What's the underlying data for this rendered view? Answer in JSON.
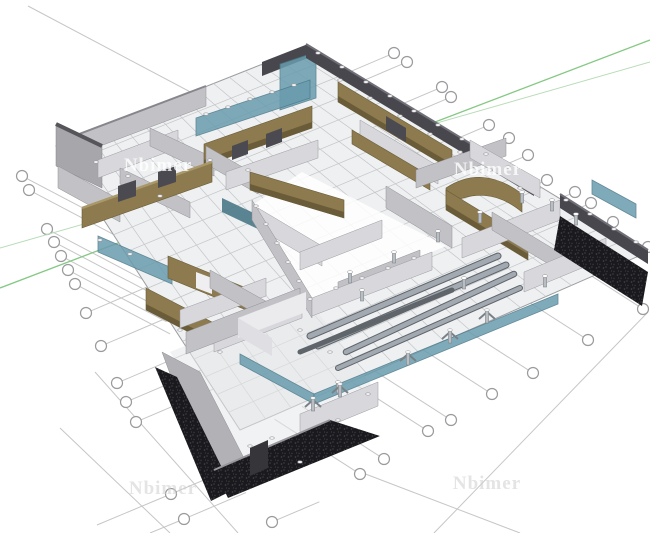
{
  "meta": {
    "description": "3D architectural BIM floor model viewed in SketchUp-style perspective viewport with structural grid axis bubbles",
    "canvas": {
      "width": 650,
      "height": 533
    }
  },
  "watermarks": [
    {
      "text": "Nbimer",
      "x": 158,
      "y": 166,
      "style": "light"
    },
    {
      "text": "Nbimer",
      "x": 488,
      "y": 170,
      "style": "light"
    },
    {
      "text": "Nbimer",
      "x": 163,
      "y": 489,
      "style": "gray"
    },
    {
      "text": "Nbimer",
      "x": 487,
      "y": 484,
      "style": "gray"
    }
  ],
  "colors": {
    "bg": "#ffffff",
    "floor": "#eef0f1",
    "tile": "#c3c5c8",
    "slabEdge": "#9b9da0",
    "wallL": "#d8d8dc",
    "wallM": "#c2c2c6",
    "wallD": "#a6a6ab",
    "wallTop": "#86868c",
    "parapet": "#47474d",
    "parapetTop": "#6f6f78",
    "wood": "#8d7a4e",
    "woodDark": "#6a5c38",
    "woodTop": "#a9986a",
    "glass": "#699cae",
    "glassDark": "#4a7888",
    "speckle": "#1a1a1e",
    "beam": "#a2a9b0",
    "beamDark": "#5f656b",
    "gridline": "#c6c6c8",
    "bubbleStroke": "#9a9a9e",
    "axisGreen": "#84c884",
    "axisGreenFaint": "#b8dcb8"
  },
  "axis_lines": [
    {
      "x1": 0,
      "y1": 288,
      "x2": 650,
      "y2": 40,
      "color": "#84c884",
      "w": 1.3
    },
    {
      "x1": 0,
      "y1": 248,
      "x2": 650,
      "y2": 62,
      "color": "#b8dcb8",
      "w": 1.0
    }
  ],
  "slab": {
    "corners": [
      [
        308,
        46
      ],
      [
        648,
        252
      ],
      [
        240,
        430
      ],
      [
        56,
        146
      ]
    ],
    "divisions": 16
  },
  "grid_bubbles": {
    "radius": 5.5,
    "groups": [
      {
        "name": "upper-left",
        "dir": [
          0.885,
          0.465
        ],
        "items": [
          [
            22,
            176,
            132
          ],
          [
            29,
            190,
            128
          ],
          [
            47,
            229,
            118
          ],
          [
            54,
            242,
            114
          ],
          [
            61,
            256,
            110
          ],
          [
            68,
            270,
            106
          ],
          [
            75,
            284,
            102
          ]
        ]
      },
      {
        "name": "lower-left",
        "dir": [
          0.92,
          -0.392
        ],
        "items": [
          [
            86,
            313,
            96
          ],
          [
            101,
            346,
            100
          ],
          [
            117,
            383,
            88
          ],
          [
            126,
            402,
            84
          ],
          [
            136,
            422,
            78
          ],
          [
            171,
            494,
            58
          ],
          [
            184,
            519,
            62
          ],
          [
            272,
            522,
            46
          ]
        ]
      },
      {
        "name": "upper-right",
        "dir": [
          -0.92,
          0.392
        ],
        "items": [
          [
            394,
            53,
            52
          ],
          [
            407,
            62,
            54
          ],
          [
            442,
            87,
            58
          ],
          [
            451,
            97,
            56
          ],
          [
            489,
            125,
            60
          ],
          [
            509,
            138,
            58
          ],
          [
            528,
            155,
            56
          ],
          [
            547,
            180,
            54
          ],
          [
            575,
            192,
            50
          ],
          [
            591,
            203,
            48
          ],
          [
            613,
            222,
            44
          ],
          [
            648,
            247,
            40
          ]
        ]
      },
      {
        "name": "lower-right",
        "dir": [
          -0.842,
          -0.54
        ],
        "items": [
          [
            360,
            474,
            96
          ],
          [
            384,
            459,
            92
          ],
          [
            428,
            431,
            84
          ],
          [
            451,
            420,
            88
          ],
          [
            492,
            394,
            92
          ],
          [
            533,
            373,
            96
          ],
          [
            588,
            340,
            100
          ],
          [
            643,
            309,
            104
          ]
        ]
      }
    ],
    "extra_lines": [
      [
        28,
        6,
        198,
        96
      ],
      [
        95,
        372,
        238,
        533
      ],
      [
        60,
        428,
        170,
        533
      ],
      [
        355,
        470,
        520,
        533
      ],
      [
        648,
        312,
        434,
        533
      ],
      [
        171,
        494,
        97,
        525
      ],
      [
        184,
        519,
        150,
        533
      ]
    ]
  },
  "columns": {
    "plain": [
      [
        350,
        272
      ],
      [
        394,
        252
      ],
      [
        438,
        231
      ],
      [
        480,
        212
      ],
      [
        522,
        192
      ],
      [
        362,
        290
      ],
      [
        338,
        382
      ],
      [
        464,
        278
      ],
      [
        545,
        276
      ],
      [
        552,
        200
      ],
      [
        576,
        214
      ]
    ],
    "y_braced": [
      [
        408,
        352
      ],
      [
        450,
        330
      ],
      [
        487,
        310
      ],
      [
        313,
        398
      ],
      [
        340,
        384
      ]
    ],
    "caps": [
      [
        318,
        53
      ],
      [
        342,
        67
      ],
      [
        366,
        82
      ],
      [
        390,
        96
      ],
      [
        414,
        111
      ],
      [
        438,
        125
      ],
      [
        462,
        139
      ],
      [
        486,
        154
      ],
      [
        508,
        167
      ],
      [
        566,
        200
      ],
      [
        590,
        214
      ],
      [
        614,
        229
      ],
      [
        636,
        242
      ],
      [
        206,
        114
      ],
      [
        228,
        107
      ],
      [
        250,
        99
      ],
      [
        272,
        92
      ],
      [
        294,
        85
      ],
      [
        256,
        206
      ],
      [
        266,
        224
      ],
      [
        277,
        243
      ],
      [
        288,
        262
      ],
      [
        299,
        281
      ],
      [
        310,
        299
      ],
      [
        336,
        288
      ],
      [
        362,
        278
      ],
      [
        388,
        268
      ],
      [
        414,
        258
      ],
      [
        96,
        162
      ],
      [
        128,
        176
      ],
      [
        160,
        196
      ],
      [
        210,
        160
      ],
      [
        248,
        170
      ],
      [
        340,
        80
      ],
      [
        370,
        98
      ],
      [
        400,
        116
      ],
      [
        430,
        134
      ],
      [
        460,
        152
      ],
      [
        490,
        170
      ],
      [
        520,
        188
      ],
      [
        100,
        240
      ],
      [
        130,
        254
      ],
      [
        250,
        446
      ],
      [
        272,
        438
      ],
      [
        300,
        462
      ],
      [
        338,
        420
      ],
      [
        368,
        394
      ],
      [
        180,
        330
      ],
      [
        220,
        352
      ],
      [
        300,
        330
      ],
      [
        330,
        352
      ]
    ]
  },
  "beams": [
    {
      "x1": 310,
      "y1": 336,
      "x2": 498,
      "y2": 256,
      "w": 5
    },
    {
      "x1": 318,
      "y1": 346,
      "x2": 506,
      "y2": 265,
      "w": 5
    },
    {
      "x1": 346,
      "y1": 352,
      "x2": 514,
      "y2": 274,
      "w": 4.5
    },
    {
      "x1": 300,
      "y1": 352,
      "x2": 452,
      "y2": 290,
      "w": 3,
      "dark": true
    },
    {
      "x1": 338,
      "y1": 368,
      "x2": 520,
      "y2": 288,
      "w": 4
    }
  ]
}
